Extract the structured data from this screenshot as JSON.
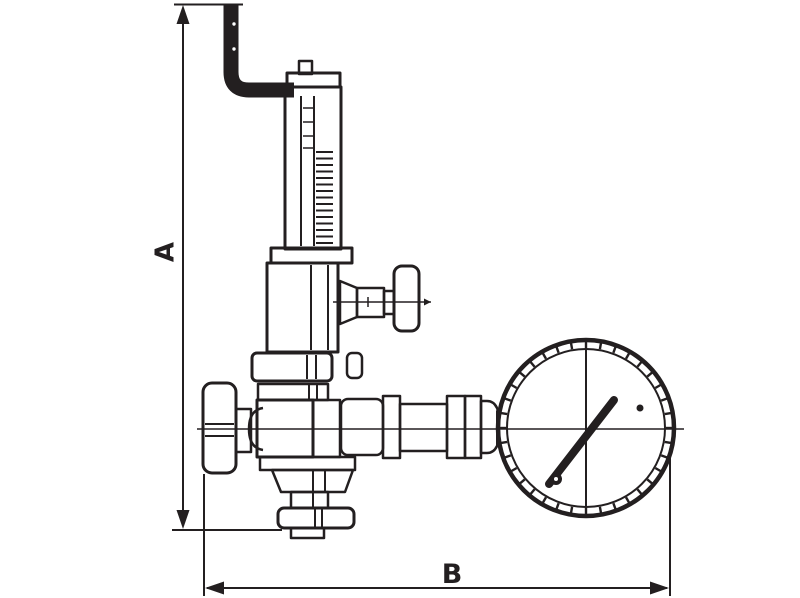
{
  "colors": {
    "ink": "#231f20",
    "paper": "#ffffff"
  },
  "dimensions": {
    "a": {
      "label": "A"
    },
    "b": {
      "label": "B"
    }
  }
}
